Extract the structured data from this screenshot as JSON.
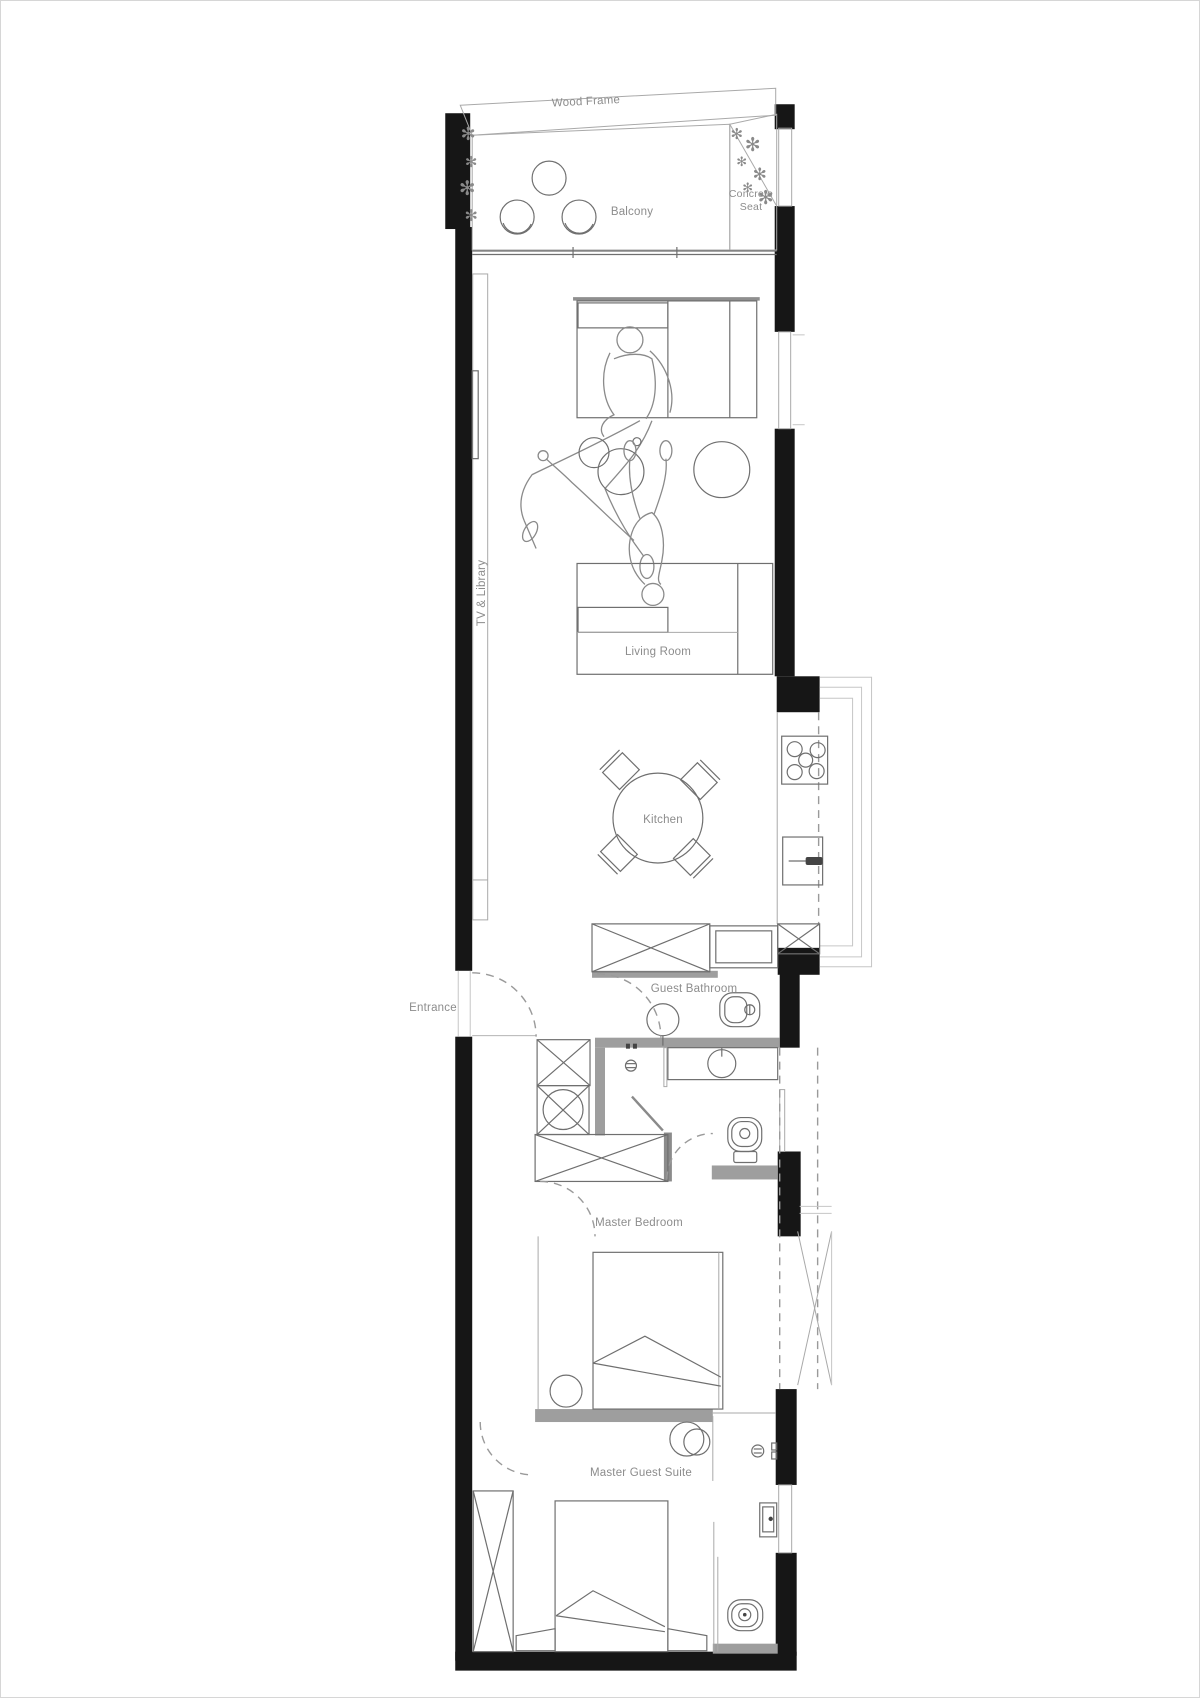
{
  "page": {
    "title": "Apartment Floor Plan"
  },
  "labels": {
    "wood_frame": "Wood Frame",
    "balcony": "Balcony",
    "concrete_seat_line1": "Concrete",
    "concrete_seat_line2": "Seat",
    "tv_library": "TV & Library",
    "living_room": "Living Room",
    "kitchen": "Kitchen",
    "guest_bathroom": "Guest Bathroom",
    "entrance": "Entrance",
    "master_bedroom": "Master Bedroom",
    "master_guest_suite": "Master Guest Suite"
  },
  "glyphs": {
    "plant": "✻"
  },
  "colors": {
    "wall": "#161616",
    "partition": "#9e9e9e",
    "line": "#6f6f6f",
    "light": "#c6c6c6",
    "label": "#8c8c8c"
  }
}
